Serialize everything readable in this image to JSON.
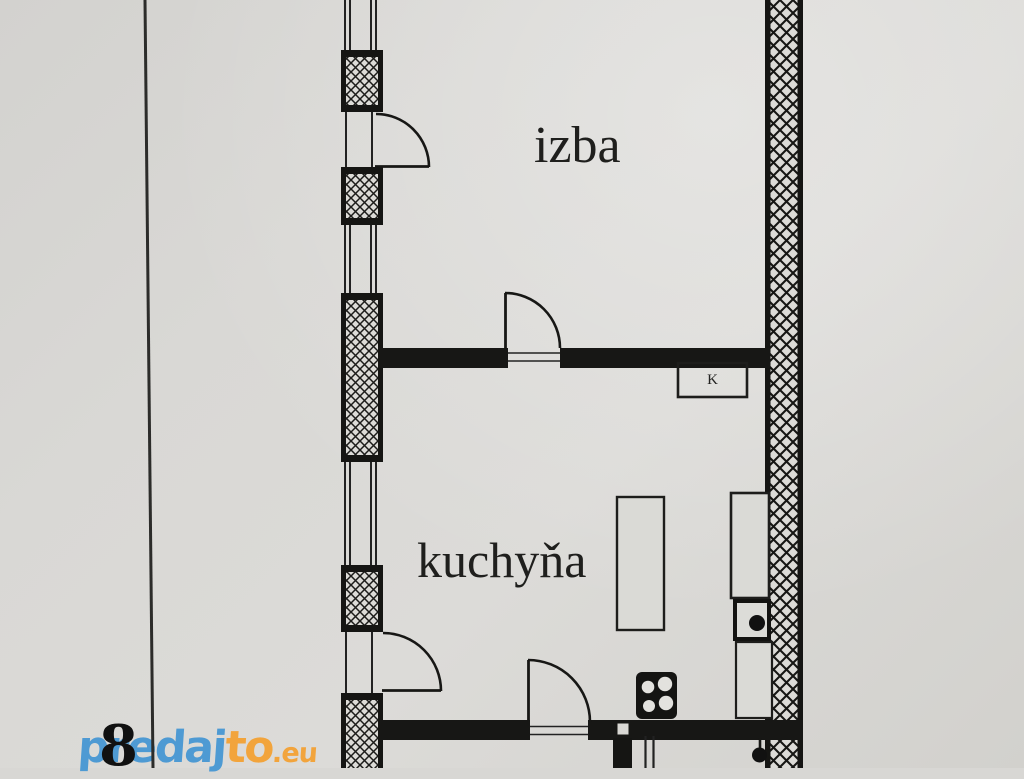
{
  "page": {
    "kind": "scanned floor plan",
    "paper_color": "#d8d7d4",
    "ink_color": "#1a1a18"
  },
  "floor_plan": {
    "rooms": [
      {
        "id": "izba",
        "label": "izba"
      },
      {
        "id": "kuchyna",
        "label": "kuchyňa"
      }
    ],
    "annotations": {
      "cabinet_label": "K",
      "dimension_number": "8"
    },
    "symbols": [
      "hatched-exterior-wall",
      "window-triple-line",
      "door-quarter-swing",
      "stove-four-burners",
      "sink-with-drain",
      "kitchen-island",
      "counter",
      "tall-cabinet"
    ]
  },
  "watermark": {
    "part_blue": "predaj",
    "part_orange": "to",
    "part_eu": ".eu",
    "blue": "#4e9ad3",
    "orange": "#f2a43c"
  }
}
